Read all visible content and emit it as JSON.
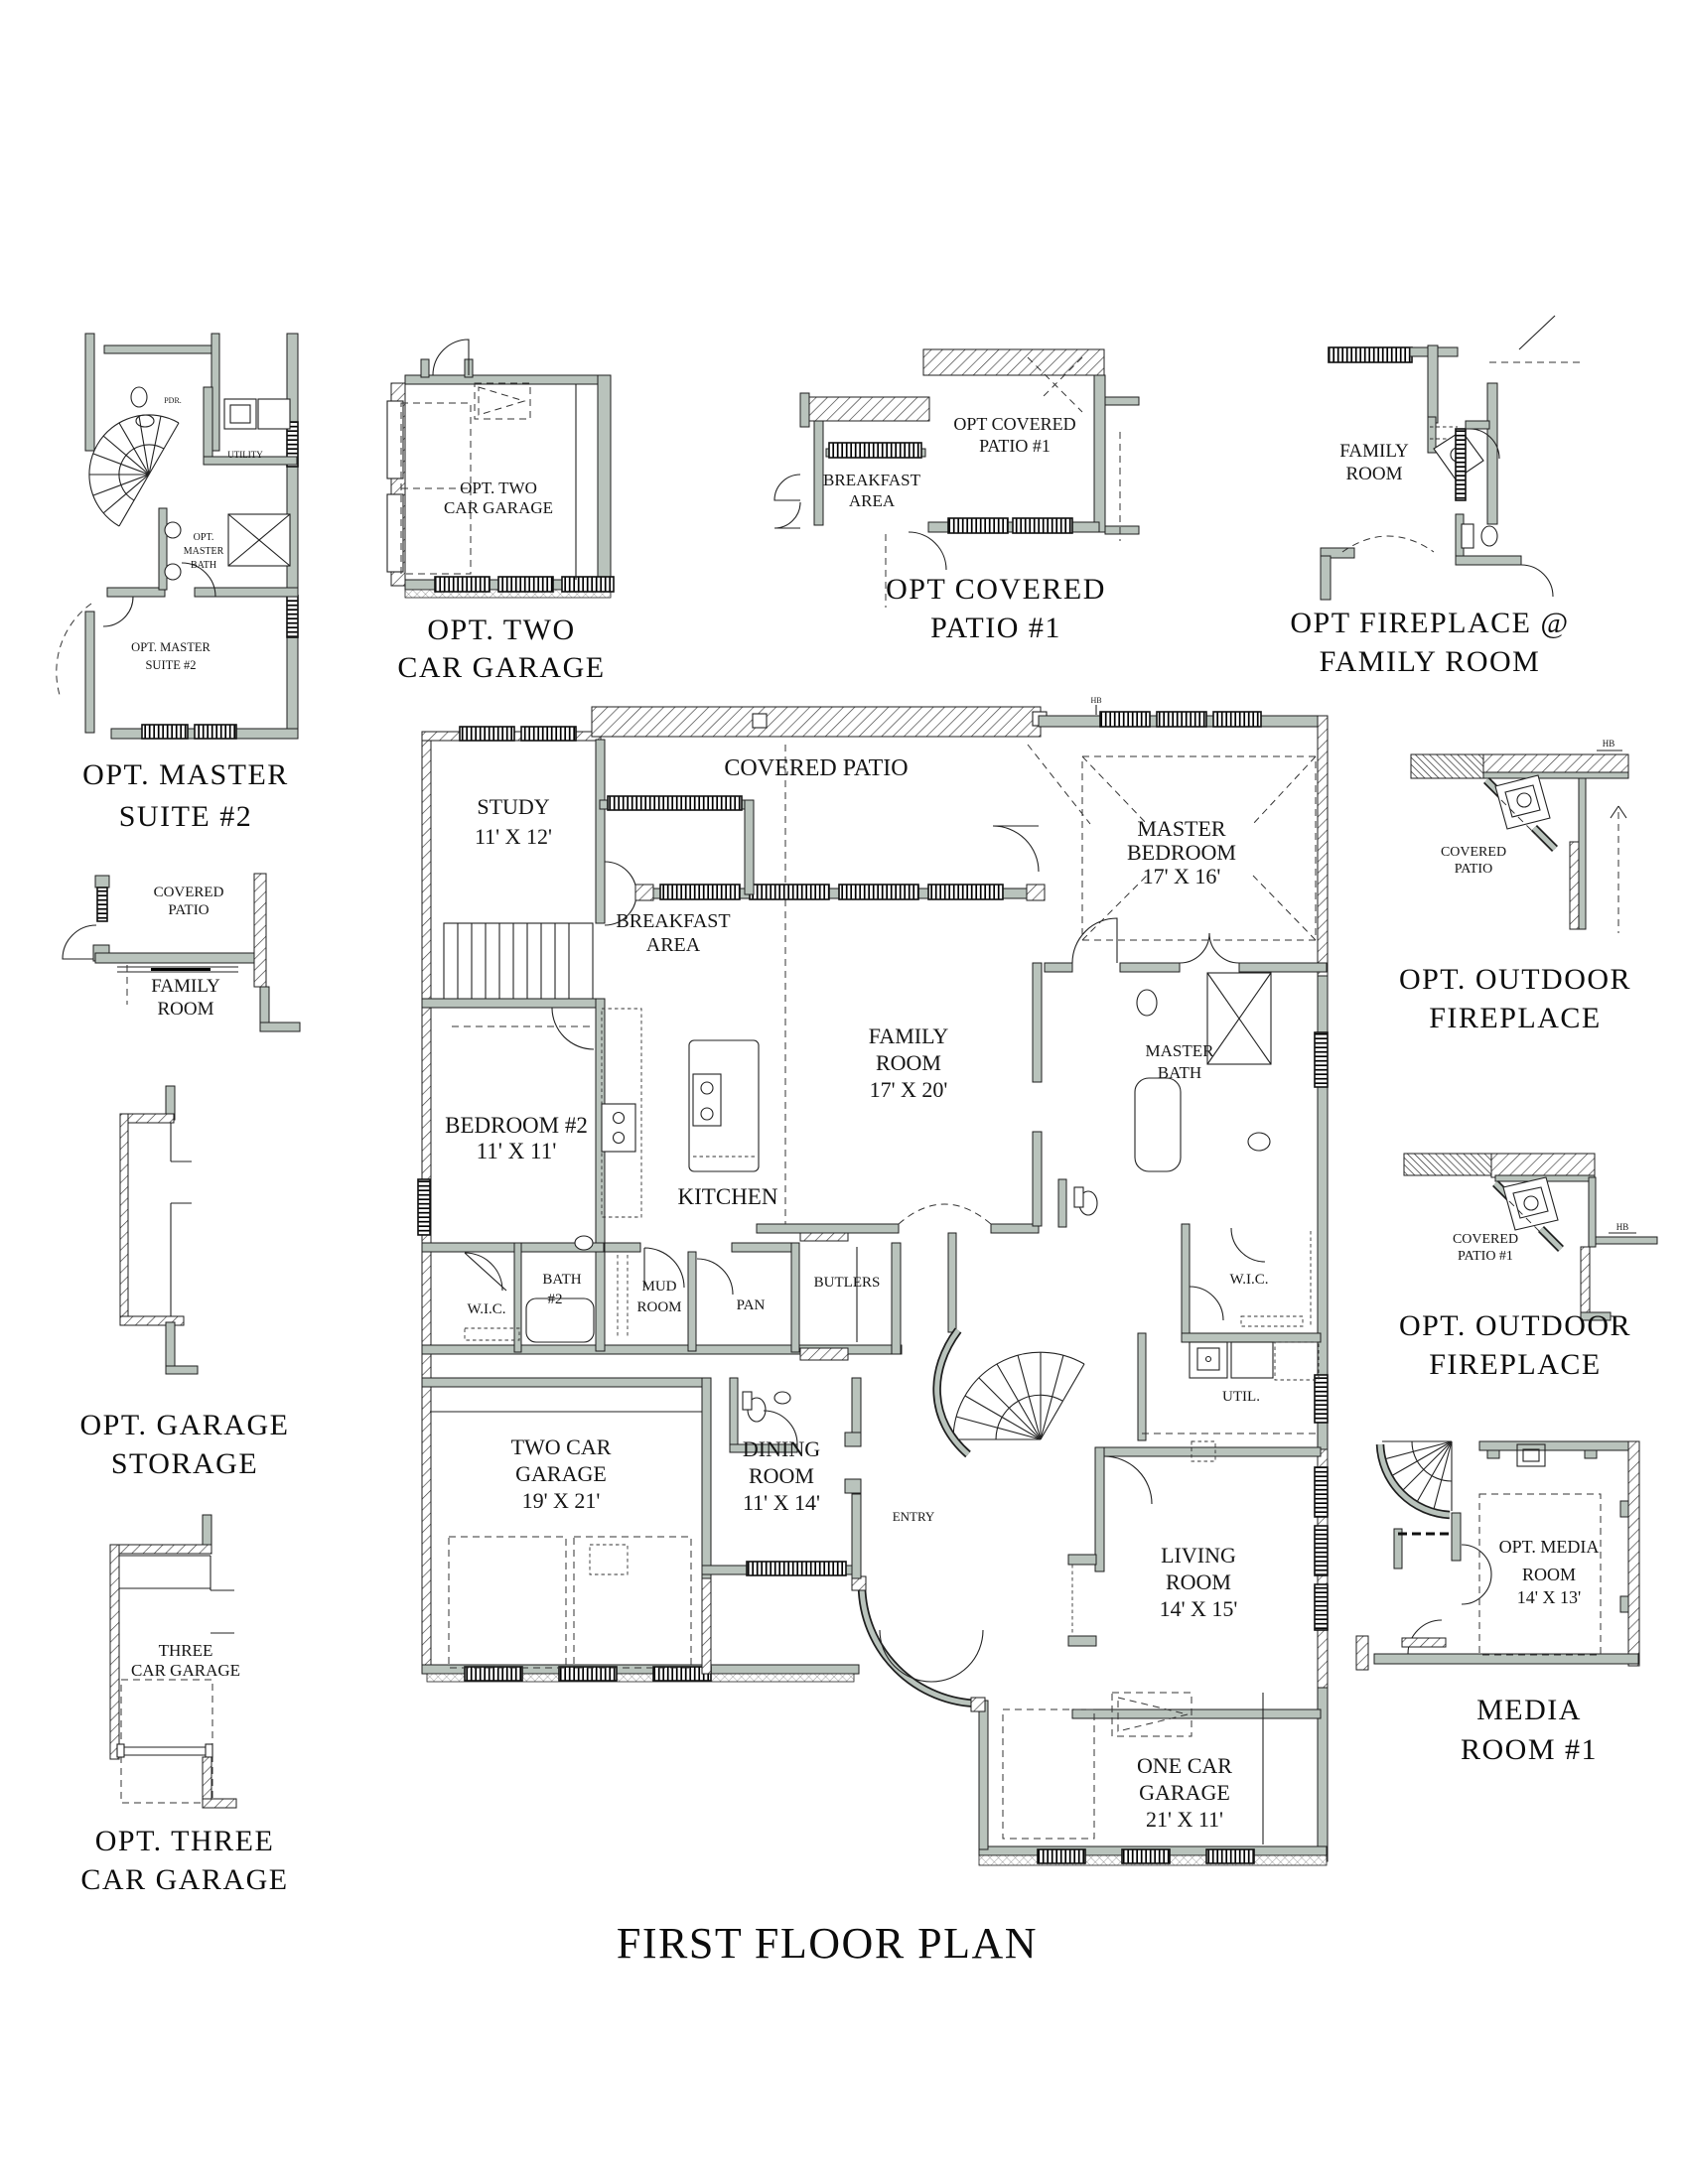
{
  "sheet": {
    "title": "FIRST FLOOR PLAN"
  },
  "colors": {
    "wall_fill": "#b9c3bc",
    "line": "#1f1f1f",
    "paper": "#ffffff"
  },
  "main_plan": {
    "rooms": {
      "covered_patio": "COVERED PATIO",
      "study_name": "STUDY",
      "study_dims": "11' X 12'",
      "breakfast_1": "BREAKFAST",
      "breakfast_2": "AREA",
      "master_bedroom_1": "MASTER",
      "master_bedroom_2": "BEDROOM",
      "master_bedroom_dims": "17' X 16'",
      "family_1": "FAMILY",
      "family_2": "ROOM",
      "family_dims": "17' X 20'",
      "master_bath_1": "MASTER",
      "master_bath_2": "BATH",
      "bedroom2_name": "BEDROOM #2",
      "bedroom2_dims": "11' X 11'",
      "kitchen": "KITCHEN",
      "wic_left": "W.I.C.",
      "bath2_1": "BATH",
      "bath2_2": "#2",
      "mud_1": "MUD",
      "mud_2": "ROOM",
      "pan": "PAN",
      "butlers": "BUTLERS",
      "wic_right": "W.I.C.",
      "util": "UTIL.",
      "garage2_1": "TWO CAR",
      "garage2_2": "GARAGE",
      "garage2_dims": "19' X 21'",
      "dining_1": "DINING",
      "dining_2": "ROOM",
      "dining_dims": "11' X 14'",
      "entry": "ENTRY",
      "living_1": "LIVING",
      "living_2": "ROOM",
      "living_dims": "14' X 15'",
      "garage1_1": "ONE CAR",
      "garage1_2": "GARAGE",
      "garage1_dims": "21' X 11'",
      "hb": "HB"
    }
  },
  "options": {
    "master_suite_2": {
      "caption_1": "OPT. MASTER",
      "caption_2": "SUITE #2",
      "pdr": "PDR.",
      "utility": "UTILITY",
      "bath_1": "OPT.",
      "bath_2": "MASTER",
      "bath_3": "BATH",
      "suite_1": "OPT. MASTER",
      "suite_2": "SUITE #2"
    },
    "two_car_garage": {
      "caption_1": "OPT.  TWO",
      "caption_2": "CAR GARAGE",
      "room_1": "OPT.  TWO",
      "room_2": "CAR GARAGE"
    },
    "covered_patio_1": {
      "caption_1": "OPT COVERED",
      "caption_2": "PATIO #1",
      "room_1": "OPT COVERED",
      "room_2": "PATIO #1",
      "breakfast_1": "BREAKFAST",
      "breakfast_2": "AREA"
    },
    "fireplace_family_room": {
      "caption_1": "OPT FIREPLACE @",
      "caption_2": "FAMILY ROOM",
      "room_1": "FAMILY",
      "room_2": "ROOM"
    },
    "covered_patio_family": {
      "patio_1": "COVERED",
      "patio_2": "PATIO",
      "family_1": "FAMILY",
      "family_2": "ROOM"
    },
    "garage_storage": {
      "caption_1": "OPT. GARAGE",
      "caption_2": "STORAGE"
    },
    "three_car_garage": {
      "caption_1": "OPT.  THREE",
      "caption_2": "CAR GARAGE",
      "room_1": "THREE",
      "room_2": "CAR GARAGE"
    },
    "outdoor_fireplace_a": {
      "caption_1": "OPT. OUTDOOR",
      "caption_2": "FIREPLACE",
      "room_1": "COVERED",
      "room_2": "PATIO",
      "hb": "HB"
    },
    "outdoor_fireplace_b": {
      "caption_1": "OPT. OUTDOOR",
      "caption_2": "FIREPLACE",
      "room_1": "COVERED",
      "room_2": "PATIO #1",
      "hb": "HB"
    },
    "media_room_1": {
      "caption_1": "MEDIA",
      "caption_2": "ROOM #1",
      "room_1": "OPT. MEDIA",
      "room_2": "ROOM",
      "room_dims": "14' X 13'"
    }
  }
}
